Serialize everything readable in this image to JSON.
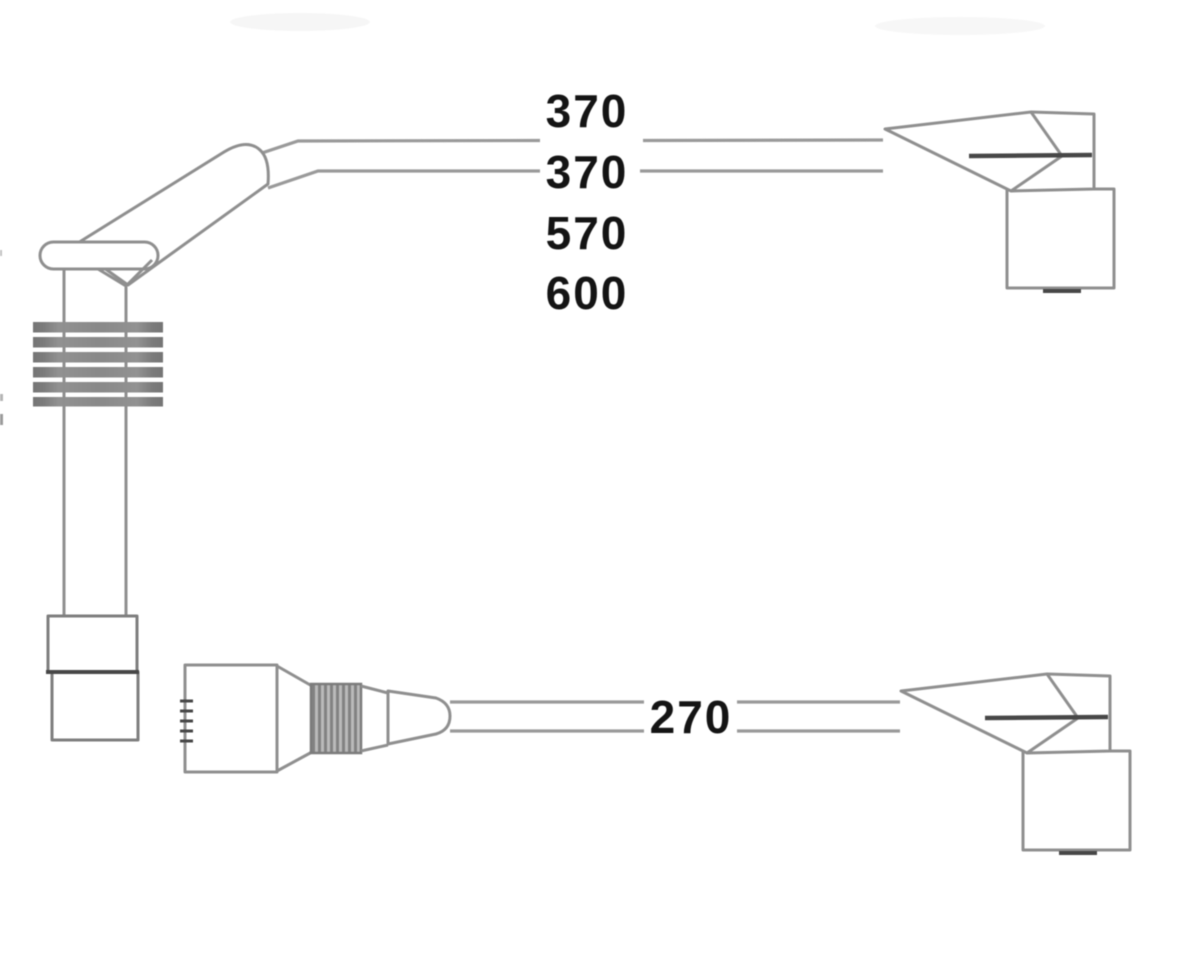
{
  "diagram": {
    "kind": "ignition-cable-set-line-drawing",
    "colors": {
      "background": "#ffffff",
      "line": "#8f8f8f",
      "line_light": "#9a9a9a",
      "line_dark": "#474747",
      "text": "#141414"
    },
    "top_cable_length_labels": [
      {
        "text": "370"
      },
      {
        "text": "370"
      },
      {
        "text": "570"
      },
      {
        "text": "600"
      }
    ],
    "bottom_cable_length_label": {
      "text": "270"
    },
    "cable_lengths_listed": [
      "370",
      "370",
      "570",
      "600",
      "270"
    ]
  }
}
